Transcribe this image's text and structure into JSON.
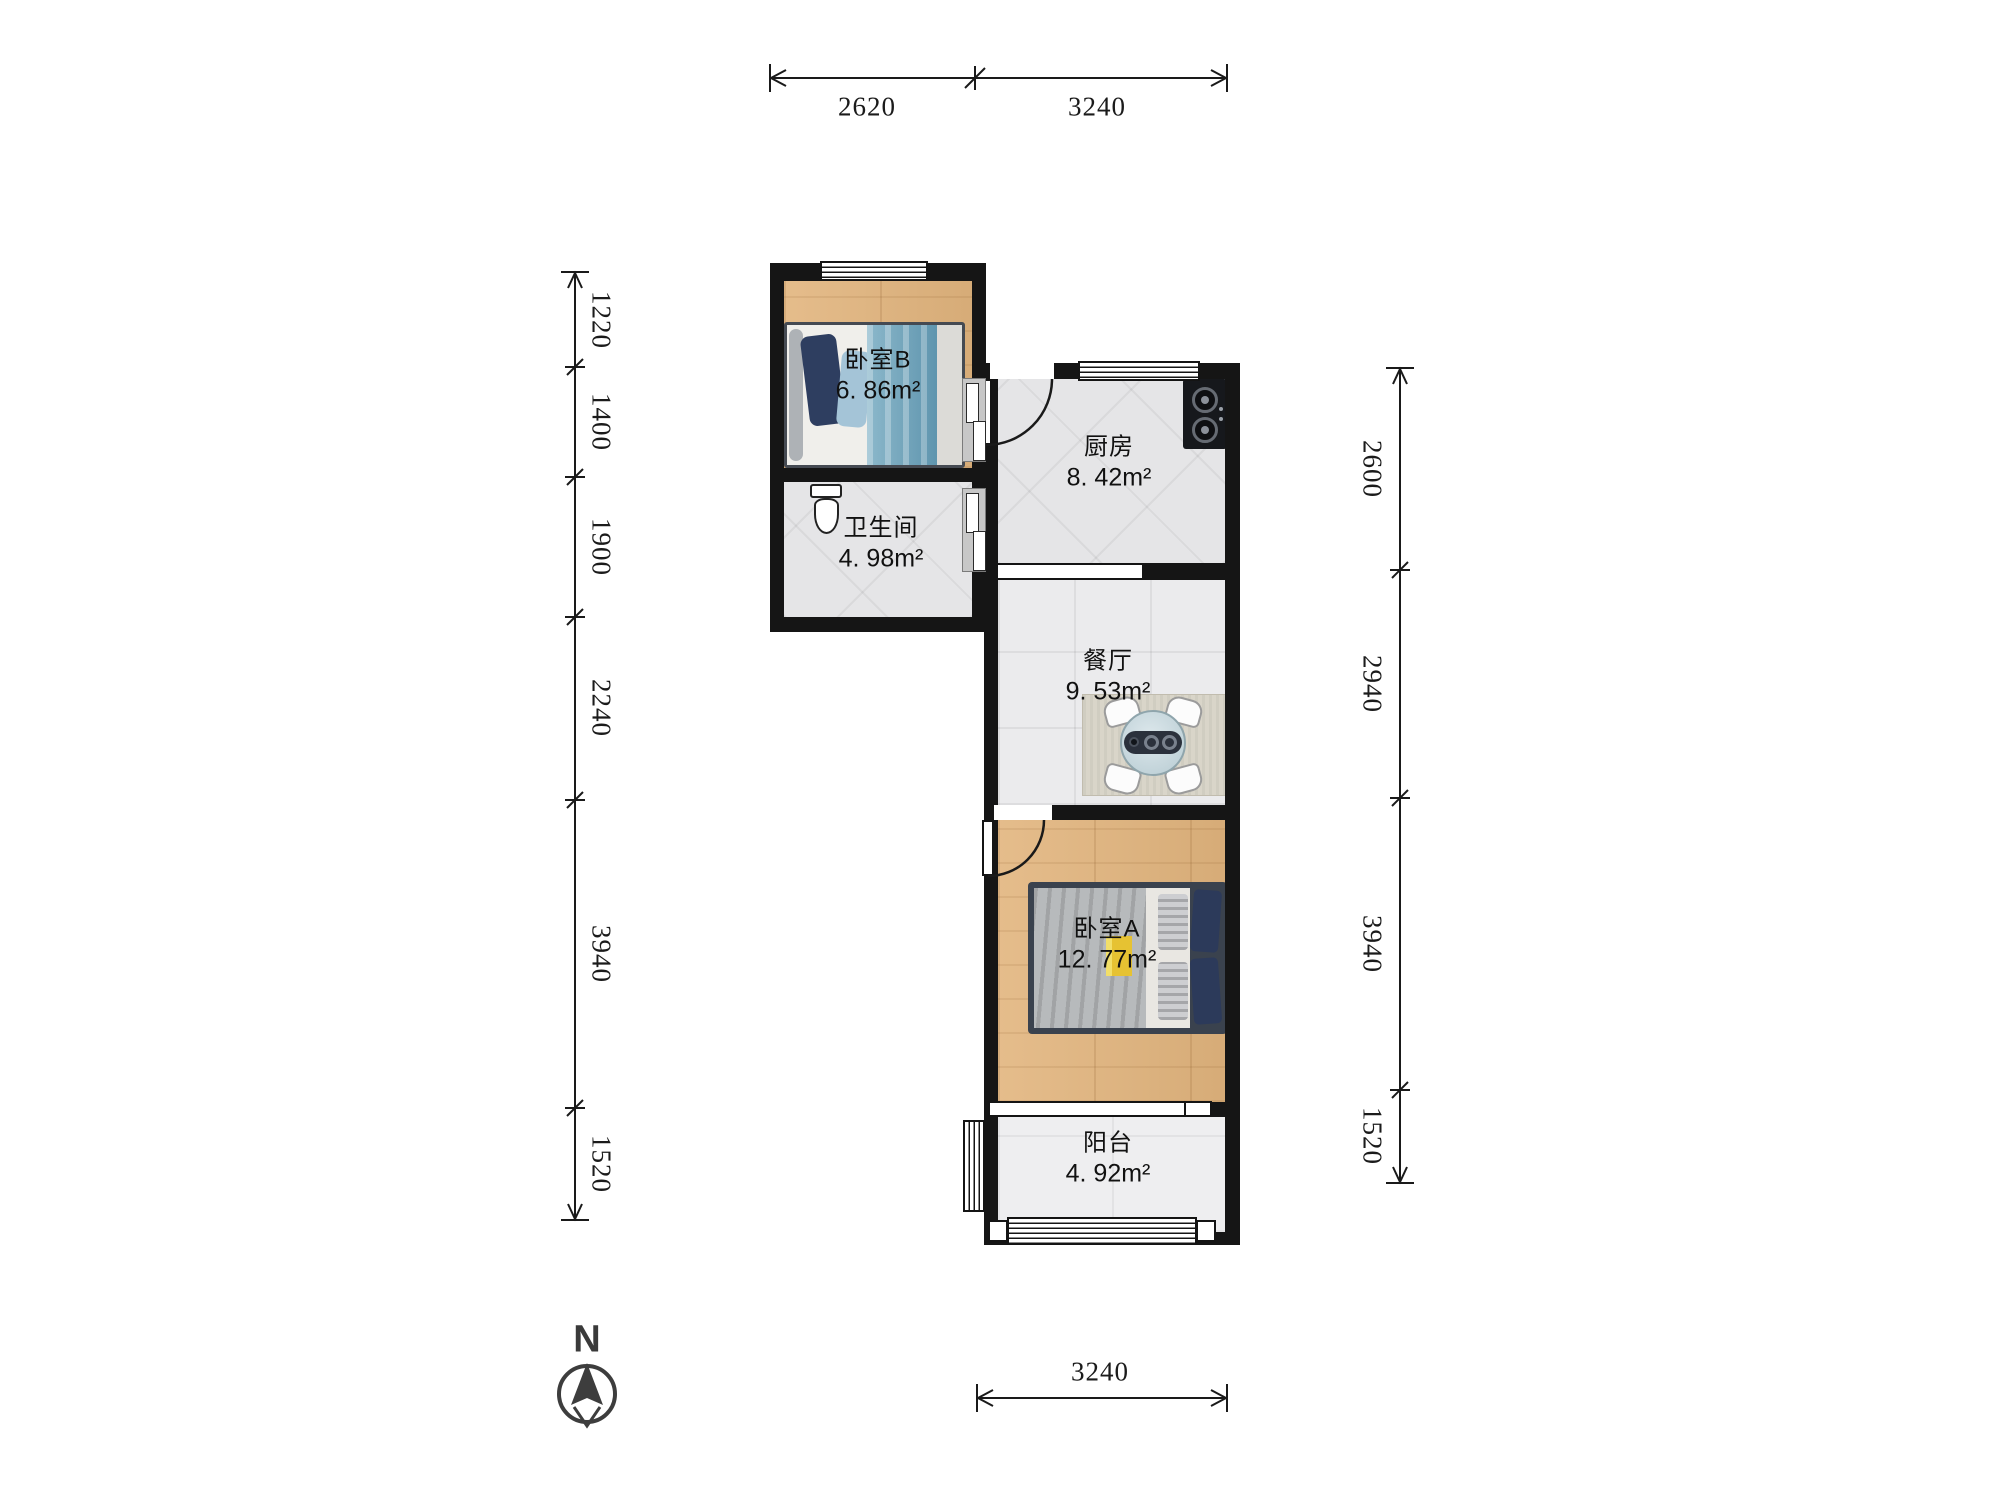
{
  "rooms": [
    {
      "name": "卧室B",
      "area": "6. 86m²"
    },
    {
      "name": "厨房",
      "area": "8. 42m²"
    },
    {
      "name": "卫生间",
      "area": "4. 98m²"
    },
    {
      "name": "餐厅",
      "area": "9. 53m²"
    },
    {
      "name": "卧室A",
      "area": "12. 77m²"
    },
    {
      "name": "阳台",
      "area": "4. 92m²"
    }
  ],
  "dimensions": {
    "top": [
      "2620",
      "3240"
    ],
    "left": [
      "1220",
      "1400",
      "1900",
      "2240",
      "3940",
      "1520"
    ],
    "right": [
      "2600",
      "2940",
      "3940",
      "1520"
    ],
    "bottom": [
      "3240"
    ]
  },
  "compass": {
    "label": "N"
  },
  "colors": {
    "wall": "#151515",
    "wood_floor": "#e2b57e",
    "tile_floor": "#e5e5e7",
    "dining_floor": "#ebebed",
    "balcony_floor": "#eeeef0",
    "blanket_teal": "#5f95ae",
    "blanket_grey": "#b7babc",
    "pillow_navy": "#2c3a5a",
    "accent_yellow": "#e6c232",
    "text": "#1b1b1b"
  }
}
